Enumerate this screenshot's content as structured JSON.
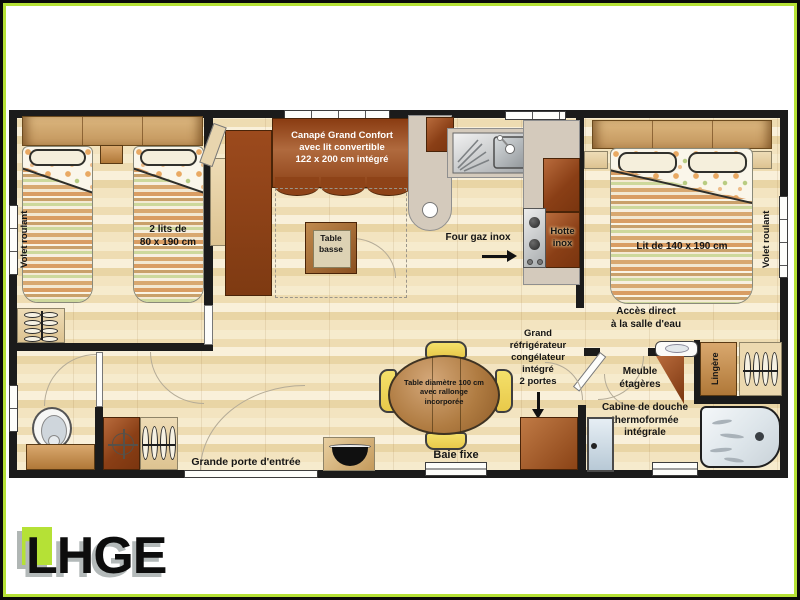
{
  "logo": {
    "text": "LHGE",
    "accent_color": "#b5e136"
  },
  "colors": {
    "wall": "#1b1b1b",
    "wood_dark": "#8a3f16",
    "floor": "#f3e4c0",
    "border_green": "#b5e136"
  },
  "labels": {
    "canape": "Canapé Grand Confort\navec lit convertible\n122 x 200 cm intégré",
    "deux_lits": "2 lits de\n80 x 190 cm",
    "table_basse": "Table\nbasse",
    "four_gaz": "Four gaz inox",
    "hotte": "Hotte\ninox",
    "lit_140": "Lit de 140 x 190 cm",
    "volet_gauche": "Volet roulant",
    "volet_droit": "Volet roulant",
    "acces": "Accès direct\nà la salle d'eau",
    "refrigerateur": "Grand\nréfrigérateur\ncongélateur\nintégré\n2 portes",
    "meuble": "Meuble\nétagères",
    "cabine": "Cabine de douche\nthermoformée\nintégrale",
    "lingere": "Lingère",
    "table_repas": "Table diamètre 100 cm\navec rallonge\nincorporée",
    "baie_fixe": "Baie fixe",
    "porte_entree": "Grande porte d'entrée"
  }
}
